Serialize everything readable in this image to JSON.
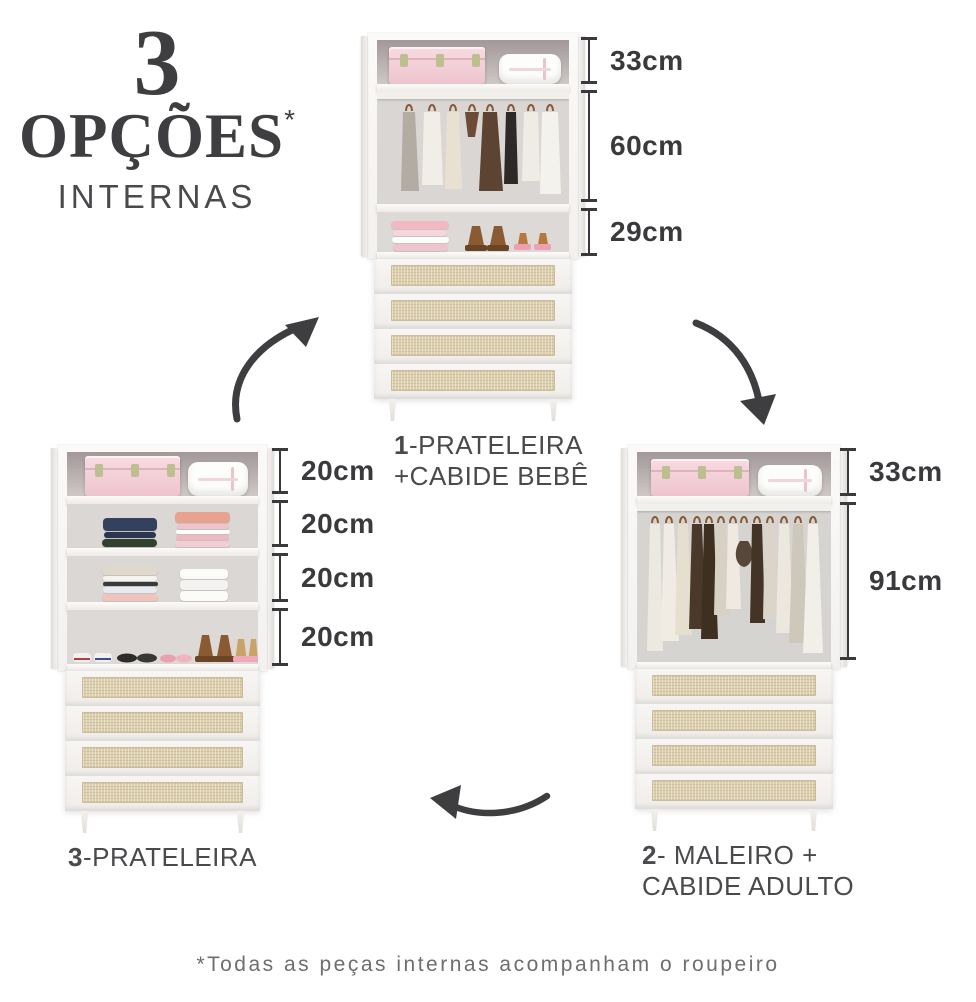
{
  "title": {
    "number": "3",
    "word": "OPÇÕES",
    "asterisk": "*",
    "subtitle": "INTERNAS"
  },
  "options": [
    {
      "number": "1",
      "name_rest": "-PRATELEIRA",
      "name_line2": "+CABIDE BEBÊ",
      "dimensions": [
        "33cm",
        "60cm",
        "29cm"
      ]
    },
    {
      "number": "2",
      "name_rest": "- MALEIRO +",
      "name_line2": "CABIDE ADULTO",
      "dimensions": [
        "33cm",
        "91cm"
      ]
    },
    {
      "number": "3",
      "name_rest": "-PRATELEIRA",
      "name_line2": "",
      "dimensions": [
        "20cm",
        "20cm",
        "20cm",
        "20cm"
      ]
    }
  ],
  "footnote": "*Todas as peças internas acompanham o roupeiro",
  "colors": {
    "ink": "#3e3e41",
    "label_text": "#4a4a4d",
    "dimension_text": "#3a3a3d",
    "footnote_text": "#6e6e71",
    "trunk_pink": "#f3ccd4",
    "rattan_beige": "#dccfad",
    "cabinet_white": "#f5f3f1"
  },
  "icons": {
    "arrow_left_to_top": "curved-arrow-up-right",
    "arrow_top_to_right": "curved-arrow-down-right",
    "arrow_right_to_left": "curved-arrow-left"
  }
}
